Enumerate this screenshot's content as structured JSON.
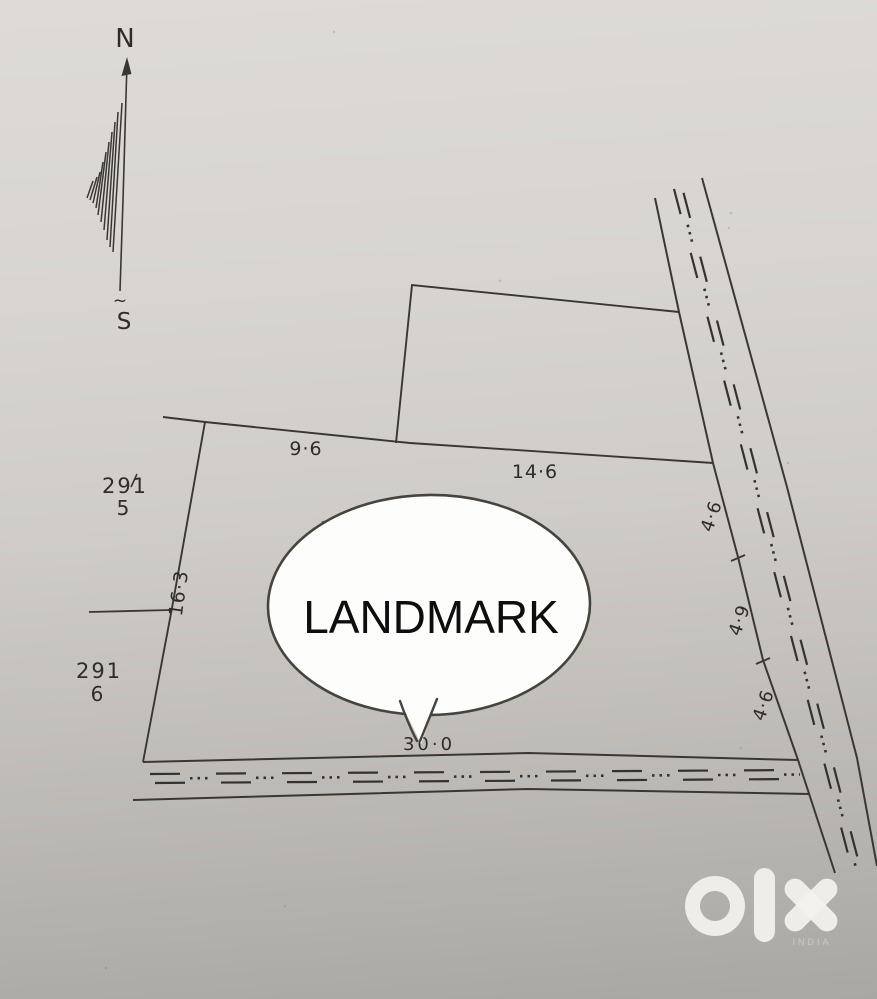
{
  "compass": {
    "north": "N",
    "south": "S",
    "squiggle": "~"
  },
  "survey_numbers": [
    {
      "number": "291",
      "subdivision": "5"
    },
    {
      "number": "291",
      "subdivision": "6"
    }
  ],
  "dimensions": {
    "top_left": "9·6",
    "top_right": "14·6",
    "left": "16·3",
    "right_top": "4·6",
    "right_middle": "4·9",
    "right_bottom": "4·6",
    "bottom": "30·0"
  },
  "landmark": {
    "label": "LANDMARK"
  },
  "watermark": {
    "brand": "olx",
    "subtext": "INDIA"
  },
  "colors": {
    "ink": "#3a3733",
    "paper_top": "#dedbd6",
    "paper_bottom": "#a9a7a4",
    "bubble_fill": "#fdfdfb",
    "bubble_stroke": "#46443f",
    "watermark_fill": "#f4f2ee"
  }
}
